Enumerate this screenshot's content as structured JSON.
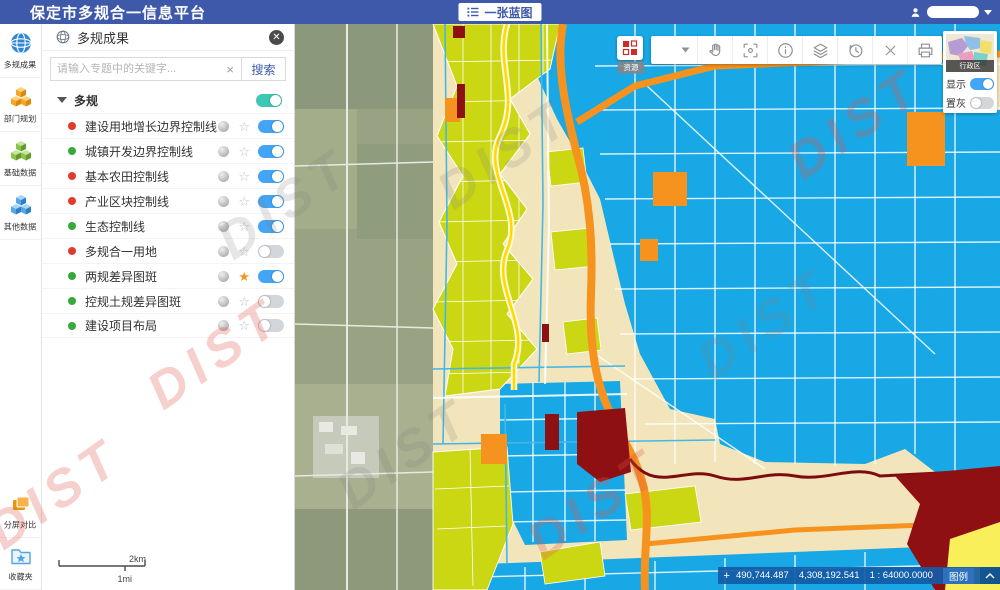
{
  "header": {
    "title": "保定市多规合一信息平台",
    "blueprint_label": "一张蓝图"
  },
  "rail": {
    "items": [
      {
        "label": "多规成果",
        "icon": "globe-icon"
      },
      {
        "label": "部门规划",
        "icon": "cubes-orange-icon"
      },
      {
        "label": "基础数据",
        "icon": "cubes-green-icon"
      },
      {
        "label": "其他数据",
        "icon": "cubes-blue-icon"
      }
    ],
    "bottom": [
      {
        "label": "分屏对比",
        "icon": "split-compare-icon"
      },
      {
        "label": "收藏夹",
        "icon": "favorites-folder-icon"
      }
    ]
  },
  "panel": {
    "title": "多规成果",
    "search_placeholder": "请输入专题中的关键字...",
    "search_button": "搜索",
    "group": {
      "label": "多规",
      "enabled": true
    },
    "layers": [
      {
        "name": "建设用地增长边界控制线",
        "dot_color": "#e23b2e",
        "starred": false,
        "enabled": true
      },
      {
        "name": "城镇开发边界控制线",
        "dot_color": "#37a93c",
        "starred": false,
        "enabled": true
      },
      {
        "name": "基本农田控制线",
        "dot_color": "#e23b2e",
        "starred": false,
        "enabled": true
      },
      {
        "name": "产业区块控制线",
        "dot_color": "#e23b2e",
        "starred": false,
        "enabled": true
      },
      {
        "name": "生态控制线",
        "dot_color": "#37a93c",
        "starred": false,
        "enabled": true
      },
      {
        "name": "多规合一用地",
        "dot_color": "#e23b2e",
        "starred": false,
        "enabled": false
      },
      {
        "name": "两规差异图斑",
        "dot_color": "#37a93c",
        "starred": true,
        "enabled": true
      },
      {
        "name": "控规土规差异图斑",
        "dot_color": "#37a93c",
        "starred": false,
        "enabled": false
      },
      {
        "name": "建设项目布局",
        "dot_color": "#37a93c",
        "starred": false,
        "enabled": false
      }
    ]
  },
  "map_toolbar": {
    "legend_button_label": "资源",
    "tools": [
      "basemap-dropdown",
      "pan",
      "zoom-extent",
      "identify",
      "layers",
      "history",
      "clear",
      "print"
    ]
  },
  "overview": {
    "region_label": "行政区",
    "show_label": "显示",
    "gray_label": "置灰",
    "show_on": true,
    "gray_on": false
  },
  "statusbar": {
    "x": "490,744.487",
    "y": "4,308,192.541",
    "scale": "1 : 64000.0000",
    "legend_label": "图例"
  },
  "scalebar": {
    "km": "2km",
    "mi": "1mi"
  },
  "watermark": {
    "text": "DIST"
  },
  "colors": {
    "header_blue": "#3e59a9",
    "toggle_on_blue": "#42a5f5",
    "group_toggle_teal": "#3cc8b4",
    "map_cyan": "#18a8e6",
    "map_parcel": "#cad712",
    "map_cream": "#f3e5bb",
    "map_orange": "#f6921e",
    "map_darkred": "#8f1013"
  }
}
